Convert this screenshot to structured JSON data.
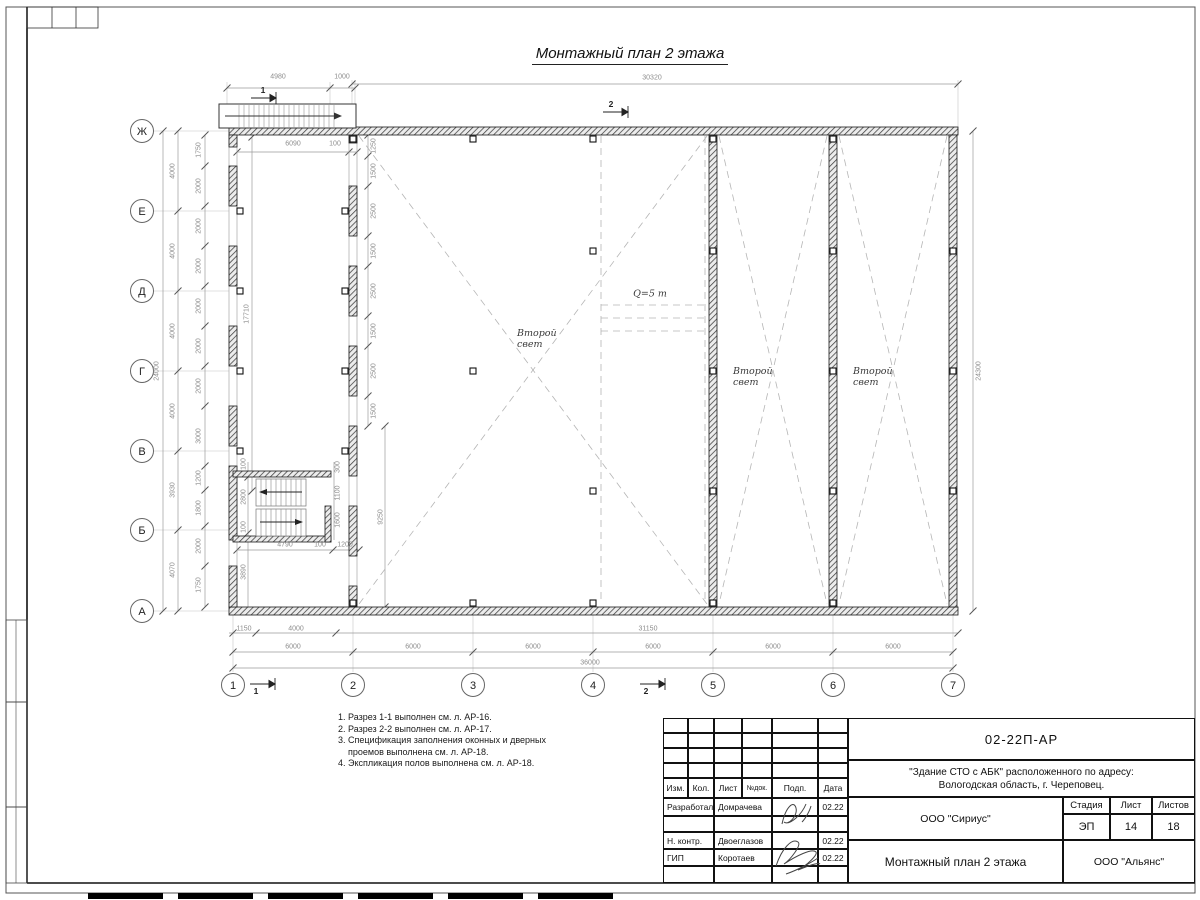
{
  "title": "Монтажный план 2 этажа",
  "axes": {
    "rows": [
      "Ж",
      "Е",
      "Д",
      "Г",
      "В",
      "Б",
      "А"
    ],
    "cols": [
      "1",
      "2",
      "3",
      "4",
      "5",
      "6",
      "7"
    ]
  },
  "labels": {
    "second_light": "Второй свет",
    "crane": "Q=5 т"
  },
  "notes": [
    "1. Разрез 1-1 выполнен см. л. АР-16.",
    "2. Разрез 2-2 выполнен см. л. АР-17.",
    "3. Спецификация заполнения оконных и дверных",
    "    проемов выполнена см. л. АР-18.",
    "4. Экспликация полов выполнена см. л. АР-18."
  ],
  "section_marks": [
    {
      "t": "1",
      "x": 263,
      "y": 90
    },
    {
      "t": "2",
      "x": 611,
      "y": 104
    },
    {
      "t": "1",
      "x": 256,
      "y": 691
    },
    {
      "t": "2",
      "x": 646,
      "y": 691
    }
  ],
  "dims": [
    [
      "4980",
      278,
      77,
      0
    ],
    [
      "1000",
      342,
      77,
      0
    ],
    [
      "30320",
      652,
      78,
      0
    ],
    [
      "24000",
      157,
      371,
      1
    ],
    [
      "4000",
      173,
      171,
      1
    ],
    [
      "4000",
      173,
      251,
      1
    ],
    [
      "4000",
      173,
      331,
      1
    ],
    [
      "4000",
      173,
      411,
      1
    ],
    [
      "3930",
      173,
      490,
      1
    ],
    [
      "4070",
      173,
      570,
      1
    ],
    [
      "1750",
      199,
      150,
      1
    ],
    [
      "2000",
      199,
      186,
      1
    ],
    [
      "2000",
      199,
      226,
      1
    ],
    [
      "2000",
      199,
      266,
      1
    ],
    [
      "2000",
      199,
      306,
      1
    ],
    [
      "2000",
      199,
      346,
      1
    ],
    [
      "2000",
      199,
      386,
      1
    ],
    [
      "3000",
      199,
      436,
      1
    ],
    [
      "1200",
      199,
      478,
      1
    ],
    [
      "1800",
      199,
      508,
      1
    ],
    [
      "2000",
      199,
      546,
      1
    ],
    [
      "1750",
      199,
      585,
      1
    ],
    [
      "24300",
      979,
      371,
      1
    ],
    [
      "1250",
      374,
      146,
      1
    ],
    [
      "1500",
      374,
      171,
      1
    ],
    [
      "2500",
      374,
      211,
      1
    ],
    [
      "1500",
      374,
      251,
      1
    ],
    [
      "2500",
      374,
      291,
      1
    ],
    [
      "1500",
      374,
      331,
      1
    ],
    [
      "2500",
      374,
      371,
      1
    ],
    [
      "1500",
      374,
      411,
      1
    ],
    [
      "9250",
      381,
      517,
      1
    ],
    [
      "6090",
      293,
      144,
      0
    ],
    [
      "100",
      335,
      144,
      0
    ],
    [
      "17710",
      247,
      314,
      1
    ],
    [
      "100",
      244,
      464,
      1
    ],
    [
      "2800",
      244,
      497,
      1
    ],
    [
      "100",
      244,
      527,
      1
    ],
    [
      "3890",
      244,
      572,
      1
    ],
    [
      "300",
      338,
      467,
      1
    ],
    [
      "1100",
      338,
      493,
      1
    ],
    [
      "1600",
      338,
      520,
      1
    ],
    [
      "4790",
      285,
      545,
      0
    ],
    [
      "100",
      320,
      545,
      0
    ],
    [
      "1200",
      345,
      545,
      0
    ],
    [
      "1150",
      244,
      629,
      0
    ],
    [
      "4000",
      296,
      629,
      0
    ],
    [
      "31150",
      648,
      629,
      0
    ],
    [
      "6000",
      293,
      647,
      0
    ],
    [
      "6000",
      413,
      647,
      0
    ],
    [
      "6000",
      533,
      647,
      0
    ],
    [
      "6000",
      653,
      647,
      0
    ],
    [
      "6000",
      773,
      647,
      0
    ],
    [
      "6000",
      893,
      647,
      0
    ],
    [
      "36000",
      590,
      663,
      0
    ]
  ],
  "titleblock": {
    "doc_number": "02-22П-АР",
    "project_line1": "\"Здание СТО с АБК\" расположенного по адресу:",
    "project_line2": "Вологодская область, г. Череповец.",
    "cols": [
      "Изм.",
      "Кол.",
      "Лист",
      "№док.",
      "Подп.",
      "Дата"
    ],
    "rows": [
      {
        "role": "Разработал",
        "name": "Домрачева",
        "date": "02.22"
      },
      {
        "role": "Н. контр.",
        "name": "Двоеглазов",
        "date": "02.22"
      },
      {
        "role": "ГИП",
        "name": "Коротаев",
        "date": "02.22"
      }
    ],
    "org_top": "ООО \"Сириус\"",
    "org_bottom": "ООО \"Альянс\"",
    "sheet_title": "Монтажный план 2 этажа",
    "stage_label": "Стадия",
    "list_label": "Лист",
    "listov_label": "Листов",
    "stage": "ЭП",
    "list": "14",
    "listov": "18"
  }
}
